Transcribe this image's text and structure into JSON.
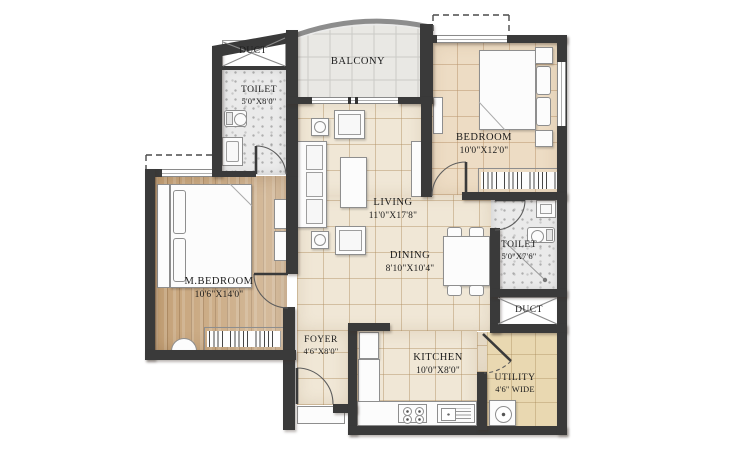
{
  "rooms": [
    {
      "key": "duct-top",
      "label": "DUCT",
      "dims": ""
    },
    {
      "key": "toilet-top",
      "label": "TOILET",
      "dims": "5'0\"X8'0\""
    },
    {
      "key": "balcony",
      "label": "BALCONY",
      "dims": ""
    },
    {
      "key": "bedroom",
      "label": "BEDROOM",
      "dims": "10'0\"X12'0\""
    },
    {
      "key": "living",
      "label": "LIVING",
      "dims": "11'0\"X17'8\""
    },
    {
      "key": "dining",
      "label": "DINING",
      "dims": "8'10\"X10'4\""
    },
    {
      "key": "toilet-right",
      "label": "TOILET",
      "dims": "5'0\"X7'6\""
    },
    {
      "key": "duct-right",
      "label": "DUCT",
      "dims": ""
    },
    {
      "key": "master-bedroom",
      "label": "M.BEDROOM",
      "dims": "10'6\"X14'0\""
    },
    {
      "key": "foyer",
      "label": "FOYER",
      "dims": "4'6\"X8'0\""
    },
    {
      "key": "kitchen",
      "label": "KITCHEN",
      "dims": "10'0\"X8'0\""
    },
    {
      "key": "utility",
      "label": "UTILITY",
      "dims": "4'6\" WIDE"
    }
  ],
  "colors": {
    "wall": "#3a3a3a",
    "floor_tile": "#f0e7d6",
    "floor_bedroom_tile": "#eddcc4",
    "floor_wood": "#c6a379",
    "floor_bath": "#eaeaea",
    "floor_balcony": "#e9e8e4",
    "floor_utility": "#e9d8b1",
    "furniture": "#fcfcfc"
  }
}
